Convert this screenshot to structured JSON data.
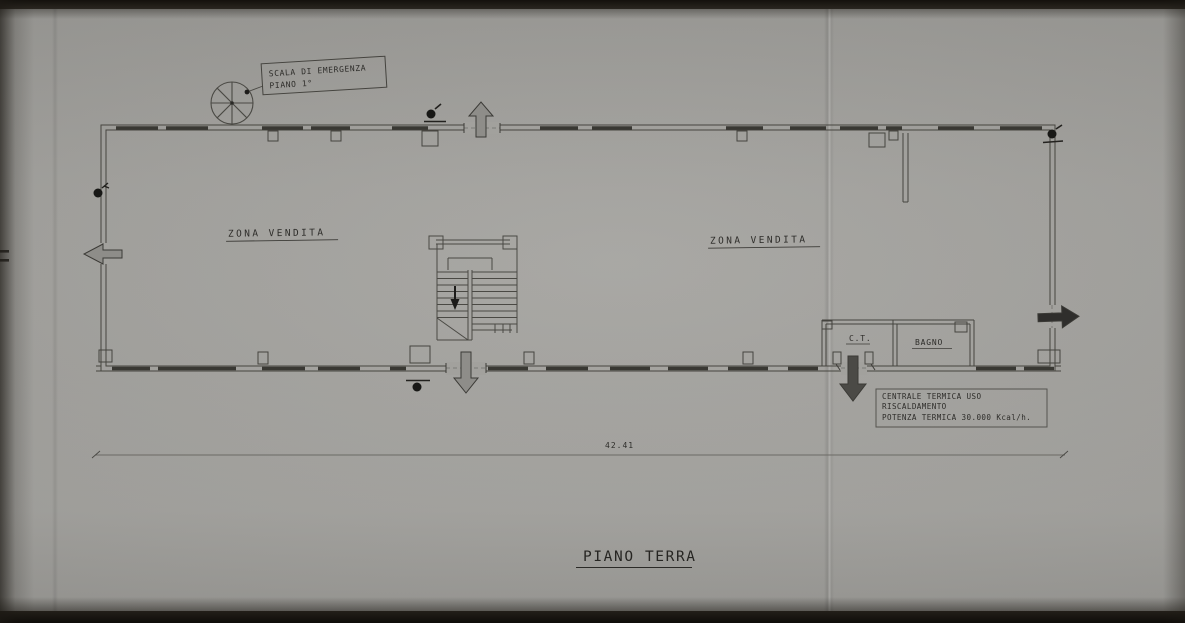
{
  "plan": {
    "title": "PIANO TERRA",
    "dimension": "42.41",
    "zones": {
      "left": "ZONA VENDITA",
      "right": "ZONA VENDITA"
    },
    "rooms": {
      "ct": "C.T.",
      "bathroom": "BAGNO"
    },
    "emergency_stair_label": {
      "line1": "SCALA DI EMERGENZA",
      "line2": "PIANO 1°"
    },
    "boiler_note": {
      "line1": "CENTRALE TERMICA USO",
      "line2": "RISCALDAMENTO",
      "line3": "POTENZA TERMICA 30.000 Kcal/h."
    }
  },
  "symbols": {
    "spiral_staircase": "spiral-staircase-icon",
    "main_staircase": "staircase-icon",
    "entrance_arrow_top": "arrow-up-icon",
    "exit_arrow_left": "arrow-left-icon",
    "exit_arrow_right": "arrow-right-icon",
    "entrance_arrow_bottom": "arrow-down-icon",
    "boiler_room_arrow": "arrow-down-icon",
    "fixture_markers": "dot-marker-icon"
  },
  "colors": {
    "paper": "#a2a19d",
    "ink": "#3a3936",
    "dark_band": "#14110d",
    "outline_arrow_fill": "#8e8d89",
    "solid_arrow_fill": "#2f2e2c"
  }
}
